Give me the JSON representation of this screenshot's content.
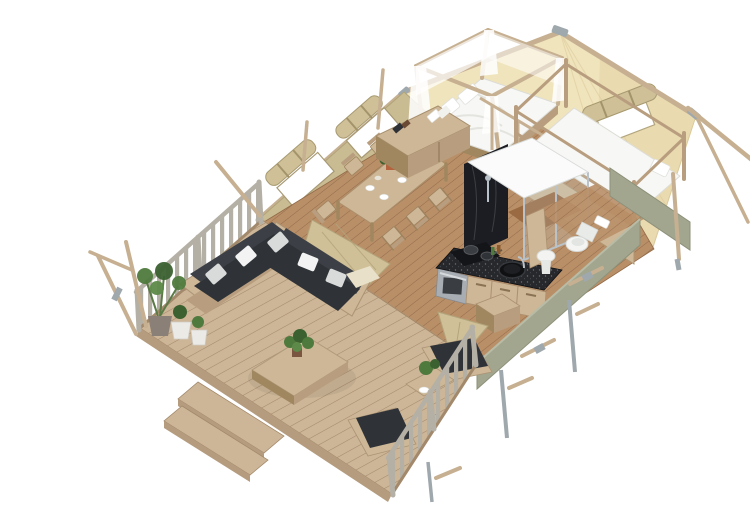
{
  "scene": {
    "type": "3d-isometric-floorplan-render",
    "title": "Safari glamping tent lodge — 3D cutaway floor plan render on white background",
    "background": "#ffffff"
  },
  "areas": [
    {
      "id": "deck",
      "label": "Outdoor terrace deck"
    },
    {
      "id": "lounge",
      "label": "Lounge corner with L-shaped sofa"
    },
    {
      "id": "dining",
      "label": "Dining area"
    },
    {
      "id": "kitchen",
      "label": "Kitchenette"
    },
    {
      "id": "master-bedroom",
      "label": "Master bedroom with canopy bed"
    },
    {
      "id": "bunk-room",
      "label": "Bunk bedroom"
    },
    {
      "id": "bathroom",
      "label": "Bathroom with shower and toilet"
    }
  ],
  "objects": {
    "roof": {
      "label": "Beige canvas tent roof with rolled window flap"
    },
    "left_wall": {
      "label": "Khaki canvas side wall with two mesh windows"
    },
    "green_walls": {
      "label": "Sage rear panel walls"
    },
    "deck": {
      "label": "Wooden terrace deck"
    },
    "steps": {
      "label": "Entry steps at deck edge"
    },
    "railing_left": {
      "label": "Deck railing, left side"
    },
    "railing_front": {
      "label": "Deck railing, front right side"
    },
    "sofa": {
      "label": "L-shaped lounge sofa with charcoal cushions and grey pillows"
    },
    "coffee_table": {
      "label": "Wooden coffee table with green plant"
    },
    "plants": {
      "label": "Potted plants at deck corner"
    },
    "benches": {
      "label": "Deck benches with planter table"
    },
    "dining": {
      "label": "Wooden dining table with six chairs and tableware"
    },
    "dresser": {
      "label": "Low dresser with towels and books"
    },
    "bed": {
      "label": "Four-poster canopy double bed with white sheer curtains"
    },
    "bunk": {
      "label": "Wooden bunk bed with white mattress"
    },
    "shower": {
      "label": "Walk-in shower cabin with glass front and white top"
    },
    "kitchen": {
      "label": "Kitchen block with hob, pots, oven and round sink"
    },
    "bathroom": {
      "label": "Toilet and wash basin on wooden floor"
    },
    "poles": {
      "label": "Timber guy poles with steel fittings"
    }
  },
  "colors": {
    "background": "#ffffff",
    "deck_wood": "#cdb697",
    "deck_gap": "#a3896b",
    "deck_edge": "#b59c7e",
    "floor_wood": "#b98f68",
    "floor_gap": "#8f6746",
    "canvas_wall": "#c9bc92",
    "canvas_roof": "#f0e4bc",
    "canvas_shade": "#e0cf9f",
    "canvas_flap": "#cfc098",
    "green_wall": "#a2a68e",
    "wood_light": "#cdb796",
    "wood_mid": "#b89e7e",
    "wood_dark": "#a0875f",
    "rail_wood": "#b5b0a6",
    "cushion": "#2f3338",
    "cushion_back": "#3c4046",
    "pillow": "#d9dbda",
    "white": "#f7f7f5",
    "counter": "#26282c",
    "steel": "#a7adb2",
    "chrome": "#b9c2c8",
    "plant": "#4f7a3d",
    "plant_dark": "#3c6130",
    "pole_wood": "#c6b091",
    "metal": "#9fa8ad",
    "glass": "#cfe4ea"
  }
}
